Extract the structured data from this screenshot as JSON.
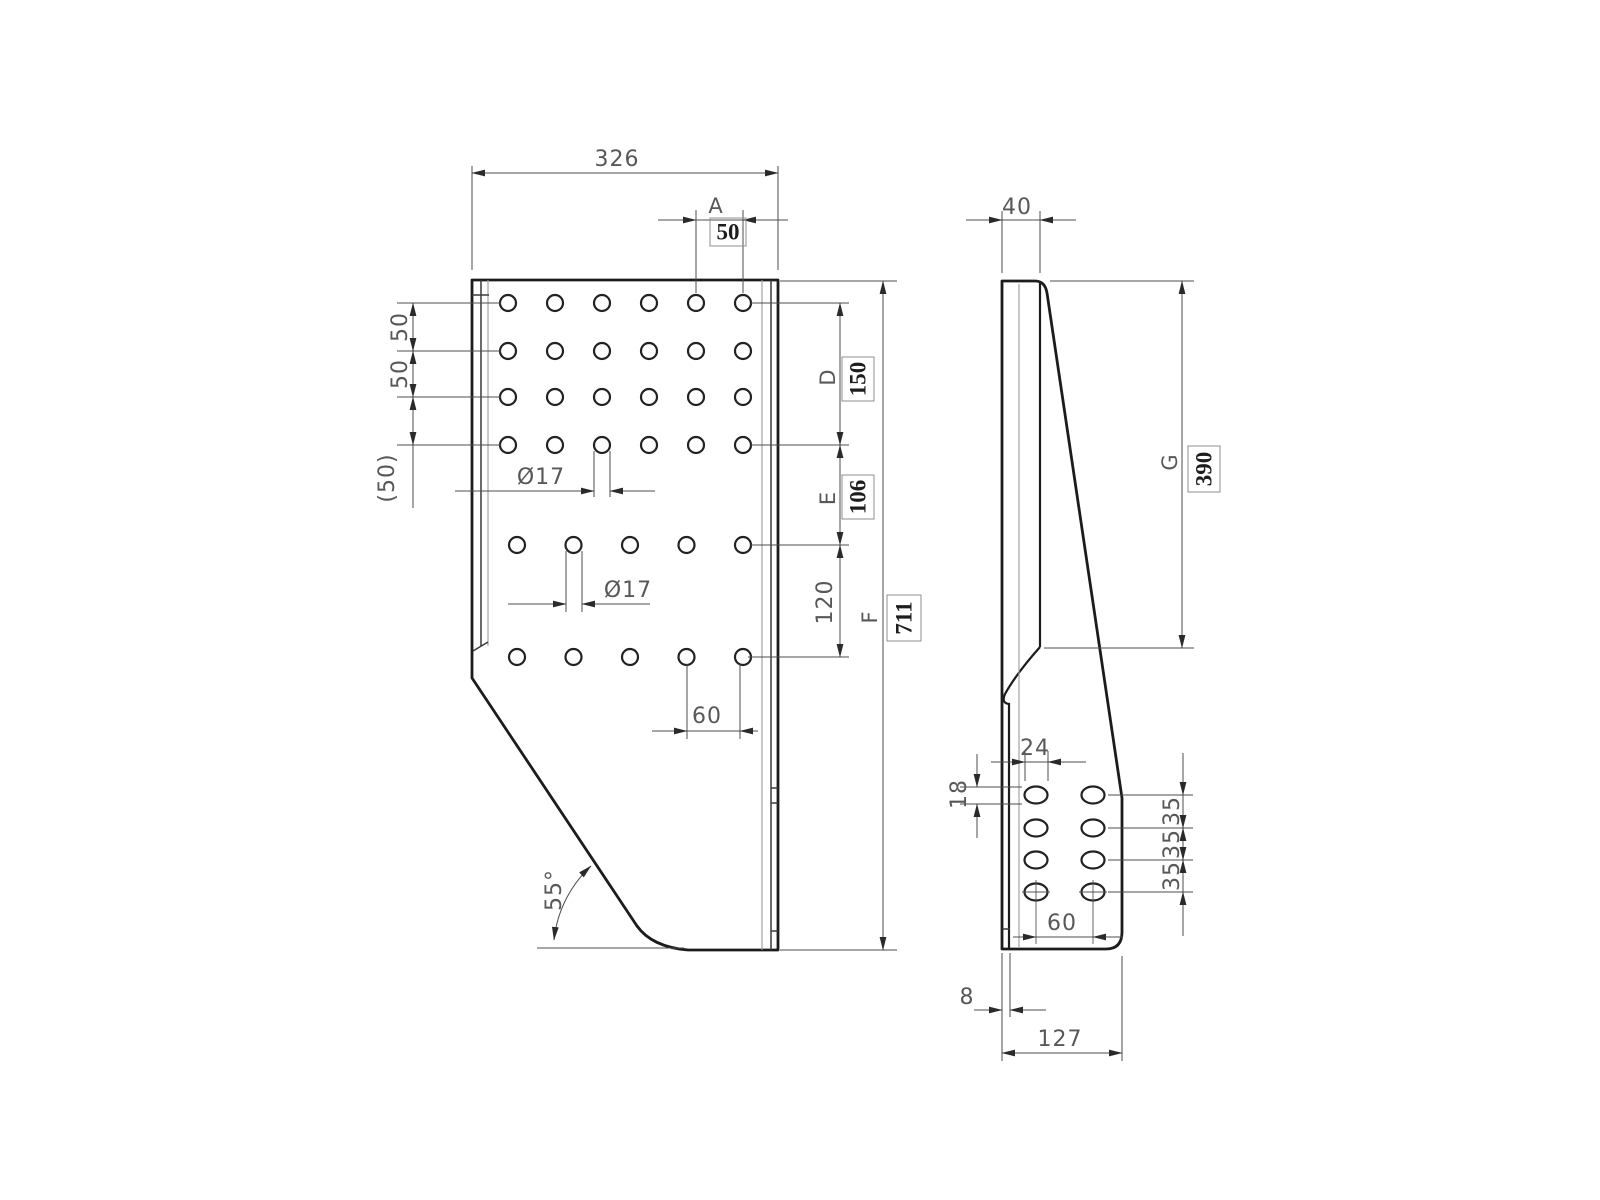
{
  "drawing": {
    "description": "Two-view dimensioned technical drawing of a perforated bent-sheet bracket plate",
    "line_color": "#1c1c1c",
    "dim_color": "#4d4d4d",
    "background": "#ffffff"
  },
  "front_view": {
    "width_dim": "326",
    "pitch_letter": "A",
    "pitch_value": "50",
    "row_pitch_1": "50",
    "row_pitch_2": "50",
    "row_pitch_ref": "(50)",
    "hole_dia_grid": "Ø17",
    "hole_dia_lower": "Ø17",
    "lower_pitch": "60",
    "bevel_angle": "55°",
    "d_letter": "D",
    "d_value": "150",
    "e_letter": "E",
    "e_value": "106",
    "e_to_bottom": "120",
    "f_letter": "F",
    "f_value": "711"
  },
  "side_view": {
    "depth": "40",
    "g_letter": "G",
    "g_value": "390",
    "slot_length": "24",
    "slot_width": "18",
    "pitch_1": "35",
    "pitch_2": "35",
    "pitch_3": "35",
    "col_pitch": "60",
    "thickness": "8",
    "base_width": "127"
  }
}
